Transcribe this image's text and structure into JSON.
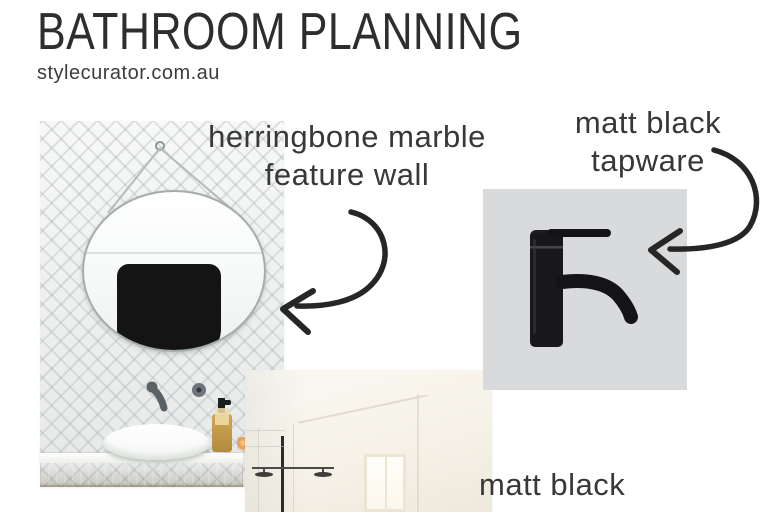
{
  "header": {
    "title": "BATHROOM PLANNING",
    "site": "stylecurator.com.au"
  },
  "annotations": {
    "feature_wall": {
      "line1": "herringbone marble",
      "line2": "feature wall"
    },
    "tapware": {
      "line1": "matt black",
      "line2": "tapware"
    },
    "matt_black": {
      "line1": "matt black"
    }
  },
  "photos": {
    "vanity_mirror": {
      "description": "round strap mirror on herringbone marble tile wall with white vessel basin, soap bottle, candle and timber vanity"
    },
    "tap_swatch": {
      "description": "matt black basin mixer tap on grey swatch"
    },
    "bright_bathroom": {
      "description": "bright white bathroom with black framed shower and window"
    }
  },
  "colors": {
    "ink": "#2e2e2e",
    "swatch-bg": "#d9dadb",
    "tile-base": "#edefee",
    "wood": "#b5894f",
    "cream": "#f7f4ec"
  }
}
